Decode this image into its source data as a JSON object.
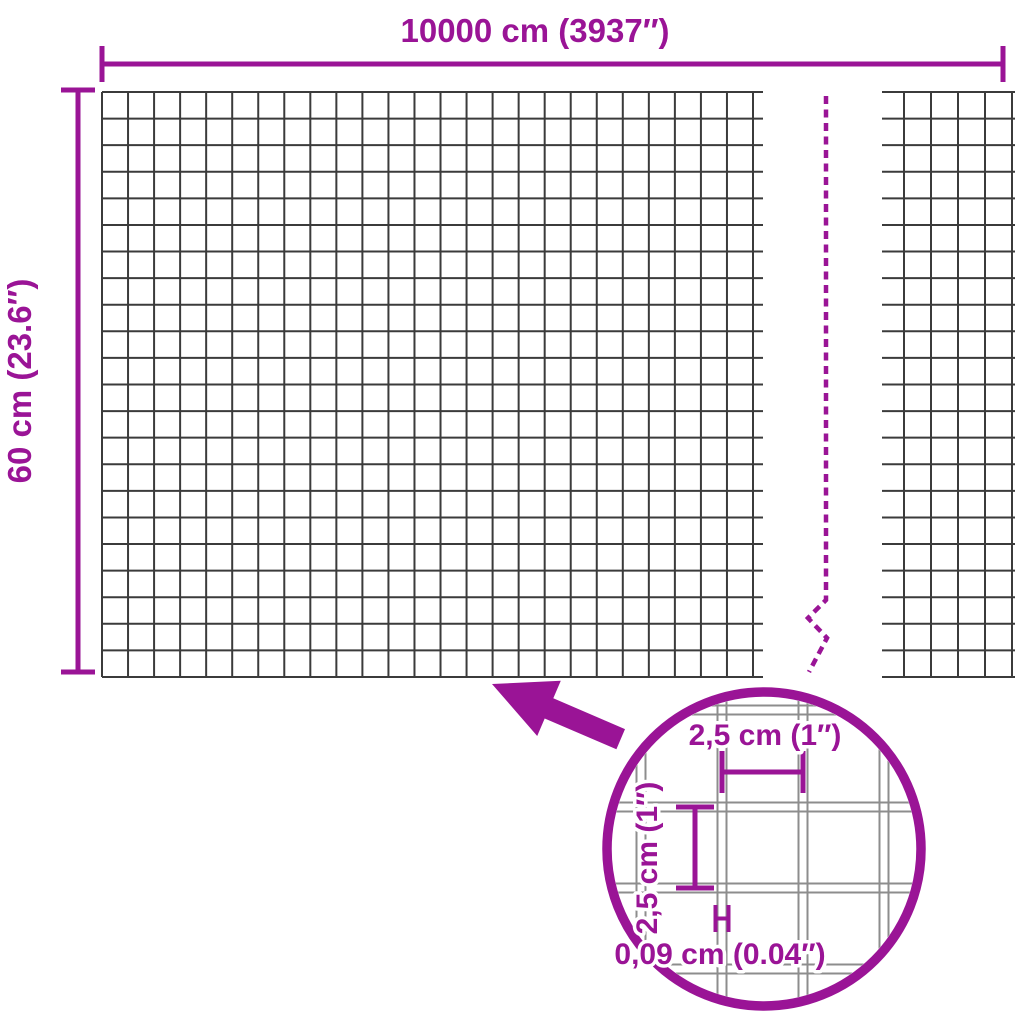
{
  "colors": {
    "accent": "#9A1496",
    "mesh": "#3B3B3B",
    "zoom_mesh": "#8D8D8D"
  },
  "labels": {
    "roll_length": "10000 cm (3937″)",
    "roll_height": "60 cm (23.6″)",
    "mesh_opening_width": "2,5 cm (1″)",
    "mesh_opening_height": "2,5 cm (1″)",
    "wire_thickness": "0,09 cm (0.04″)"
  }
}
